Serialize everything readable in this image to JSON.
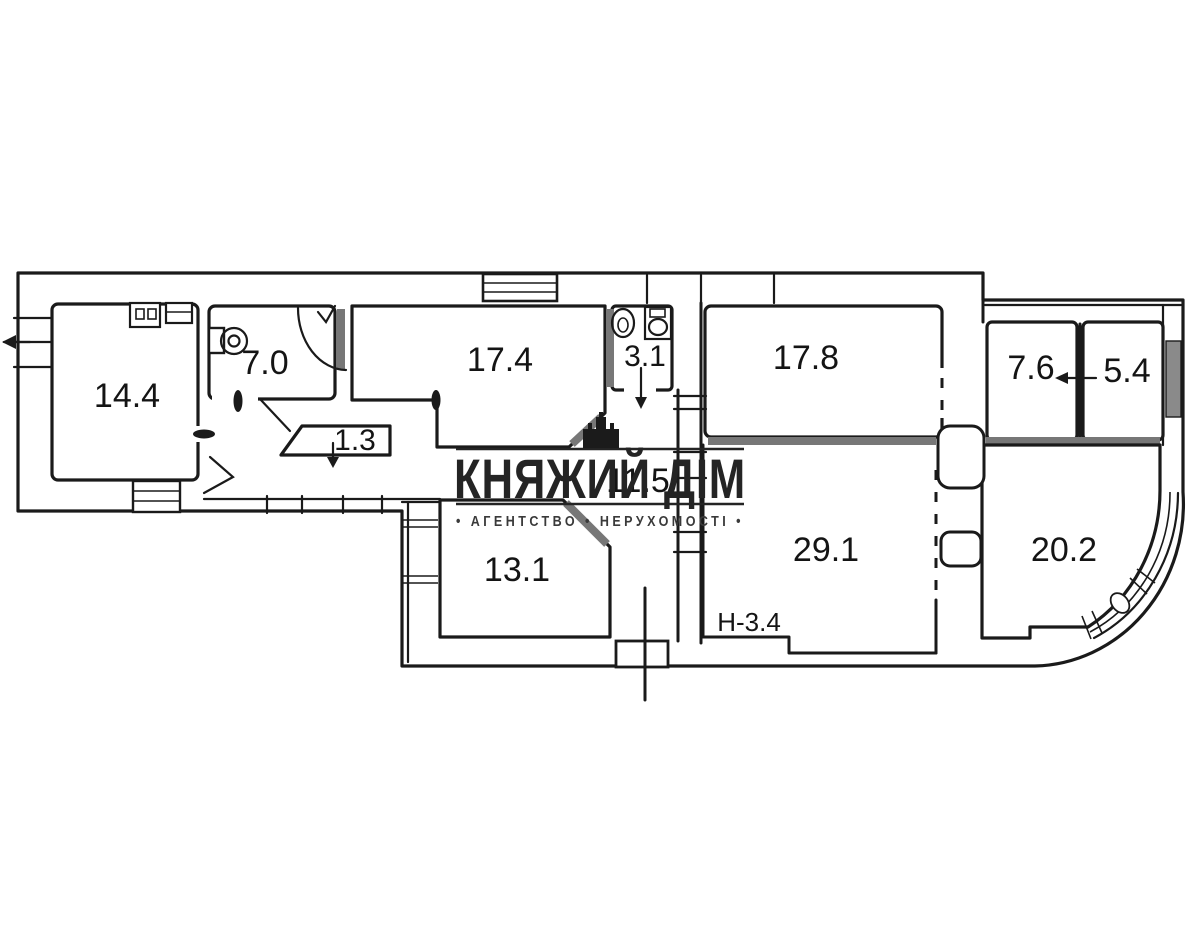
{
  "plan": {
    "rooms": [
      {
        "key": "room-14-4",
        "area": "14.4"
      },
      {
        "key": "room-7-0",
        "area": "7.0"
      },
      {
        "key": "room-17-4",
        "area": "17.4"
      },
      {
        "key": "room-3-1",
        "area": "3.1"
      },
      {
        "key": "room-17-8",
        "area": "17.8"
      },
      {
        "key": "room-7-6",
        "area": "7.6"
      },
      {
        "key": "room-5-4",
        "area": "5.4"
      },
      {
        "key": "closet-1-3",
        "area": "1.3"
      },
      {
        "key": "corridor-11-5",
        "area": "11.5"
      },
      {
        "key": "room-13-1",
        "area": "13.1"
      },
      {
        "key": "room-29-1",
        "area": "29.1"
      },
      {
        "key": "room-20-2",
        "area": "20.2"
      }
    ],
    "height_note": "Н-3.4"
  },
  "watermark": {
    "title": "КНЯЖИЙ ДІМ",
    "subtitle": "• АГЕНТСТВО • НЕРУХОМОСТІ •"
  },
  "colors": {
    "ink": "#1a1a1a",
    "wall_gray": "#777777",
    "watermark": "#242424",
    "background": "#ffffff"
  }
}
